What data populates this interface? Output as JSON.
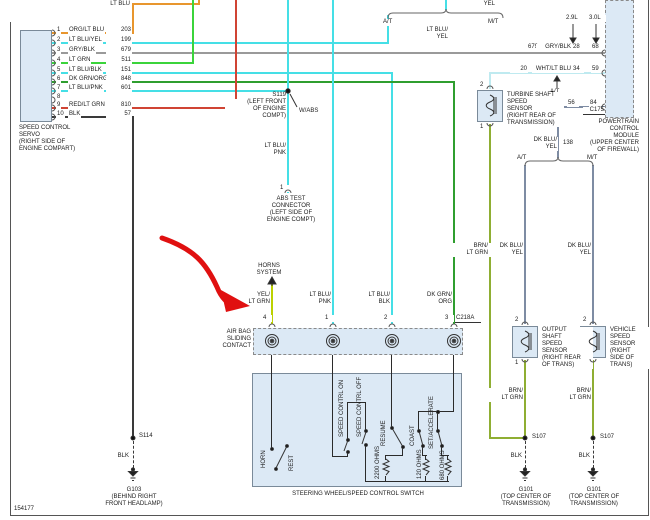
{
  "page": {
    "diagram_id": "154177"
  },
  "palette": {
    "org": "#e8962e",
    "cyn": "#45dfe6",
    "gry": "#9a9a9a",
    "grn": "#3bd43b",
    "dkg": "#2f9e2f",
    "red": "#d04434",
    "blk": "#3a3a3a",
    "ylg": "#bcd100",
    "wht": "#bfeaf0",
    "dkb": "#7e8ca3",
    "olv": "#8fae33",
    "int": "#2b2b2b",
    "box_fill": "#dce9f5",
    "annotation": "#e01010"
  },
  "servo": {
    "name": [
      "SPEED CONTROL",
      "SERVO",
      "(RIGHT SIDE OF",
      "ENGINE COMPART)"
    ],
    "pins": [
      {
        "pin": "1",
        "color": "ORG/LT BLU",
        "circuit": "203"
      },
      {
        "pin": "2",
        "color": "LT BLU/YEL",
        "circuit": "199"
      },
      {
        "pin": "3",
        "color": "GRY/BLK",
        "circuit": "679"
      },
      {
        "pin": "4",
        "color": "LT GRN",
        "circuit": "511"
      },
      {
        "pin": "5",
        "color": "LT BLU/BLK",
        "circuit": "151"
      },
      {
        "pin": "6",
        "color": "DK GRN/ORG",
        "circuit": "848"
      },
      {
        "pin": "7",
        "color": "LT BLU/PNK",
        "circuit": "601"
      },
      {
        "pin": "8",
        "color": "",
        "circuit": ""
      },
      {
        "pin": "9",
        "color": "RED/LT GRN",
        "circuit": "810"
      },
      {
        "pin": "10",
        "color": "BLK",
        "circuit": "57"
      }
    ]
  },
  "top": {
    "lt_blu": "LT BLU",
    "yel": "YEL",
    "at": "A/T",
    "mt": "M/T",
    "lt_blu_yel": [
      "LT BLU/",
      "YEL"
    ]
  },
  "pcm": {
    "name": [
      "POWERTRAIN",
      "CONTROL",
      "MODULE",
      "(UPPER CENTER",
      "OF FIREWALL)"
    ],
    "connector": "C175",
    "eng_a": "2.9L",
    "eng_b": "3.0L",
    "at": "A/T",
    "rows": {
      "gry": {
        "circuit": "679",
        "color": "GRY/BLK",
        "a": "28",
        "b": "68"
      },
      "wht": {
        "circuit": "20",
        "color": "WHT/LT BLU",
        "a": "34",
        "b": "59"
      },
      "dkb": {
        "a": "56",
        "b": "84"
      }
    }
  },
  "s119": {
    "id": "S119",
    "loc": [
      "(LEFT FRONT",
      "OF ENGINE",
      "COMPT)"
    ],
    "note": "W/ABS"
  },
  "abs": {
    "pin": "1",
    "name": [
      "ABS TEST",
      "CONNECTOR",
      "(LEFT SIDE OF",
      "ENGINE COMPT)"
    ],
    "wire": [
      "LT BLU/",
      "PNK"
    ]
  },
  "horns": {
    "name": [
      "HORNS",
      "SYSTEM"
    ],
    "wire": [
      "YEL/",
      "LT GRN"
    ]
  },
  "cs": {
    "name": [
      "AIR BAG",
      "SLIDING",
      "CONTACT"
    ],
    "connector": "C218A",
    "pins": [
      "4",
      "1",
      "2",
      "3"
    ],
    "w1": [
      "LT BLU/",
      "PNK"
    ],
    "w2": [
      "LT BLU/",
      "BLK"
    ],
    "w3": [
      "DK GRN/",
      "ORG"
    ]
  },
  "sw": {
    "caption": "STEERING WHEEL/SPEED CONTROL SWITCH",
    "horn": "HORN",
    "rest": "REST",
    "on": "SPEED CONTRL ON",
    "off": "SPEED CONTRL OFF",
    "resume": "RESUME",
    "coast": "COAST",
    "set": "SET/ACCELERATE",
    "r2200": "2200 OHMS",
    "r120": "120 OHMS",
    "r680": "680 OHMS"
  },
  "turbine": {
    "name": [
      "TURBINE SHAFT",
      "SPEED",
      "SENSOR",
      "(RIGHT REAR OF",
      "TRANSMISSION)"
    ],
    "p2": "2",
    "p1": "1"
  },
  "output": {
    "name": [
      "OUTPUT",
      "SHAFT",
      "SPEED",
      "SENSOR",
      "(RIGHT REAR",
      "OF TRANS)"
    ],
    "p2": "2",
    "p1": "1"
  },
  "vehicle": {
    "name": [
      "VEHICLE",
      "SPEED",
      "SENSOR",
      "(RIGHT",
      "SIDE OF",
      "TRANS)"
    ],
    "p2": "2",
    "p1": "1"
  },
  "dkby": {
    "wire": [
      "DK BLU/",
      "YEL"
    ],
    "circuit": "138",
    "at": "A/T",
    "mt": "M/T"
  },
  "brn": {
    "wire": [
      "BRN/",
      "LT GRN"
    ]
  },
  "gnd": {
    "blk": "BLK",
    "s114": "S114",
    "s107": "S107",
    "g103": [
      "G103",
      "(BEHIND RIGHT",
      "FRONT HEADLAMP)"
    ],
    "g101": [
      "G101",
      "(TOP CENTER OF",
      "TRANSMISSION)"
    ]
  }
}
